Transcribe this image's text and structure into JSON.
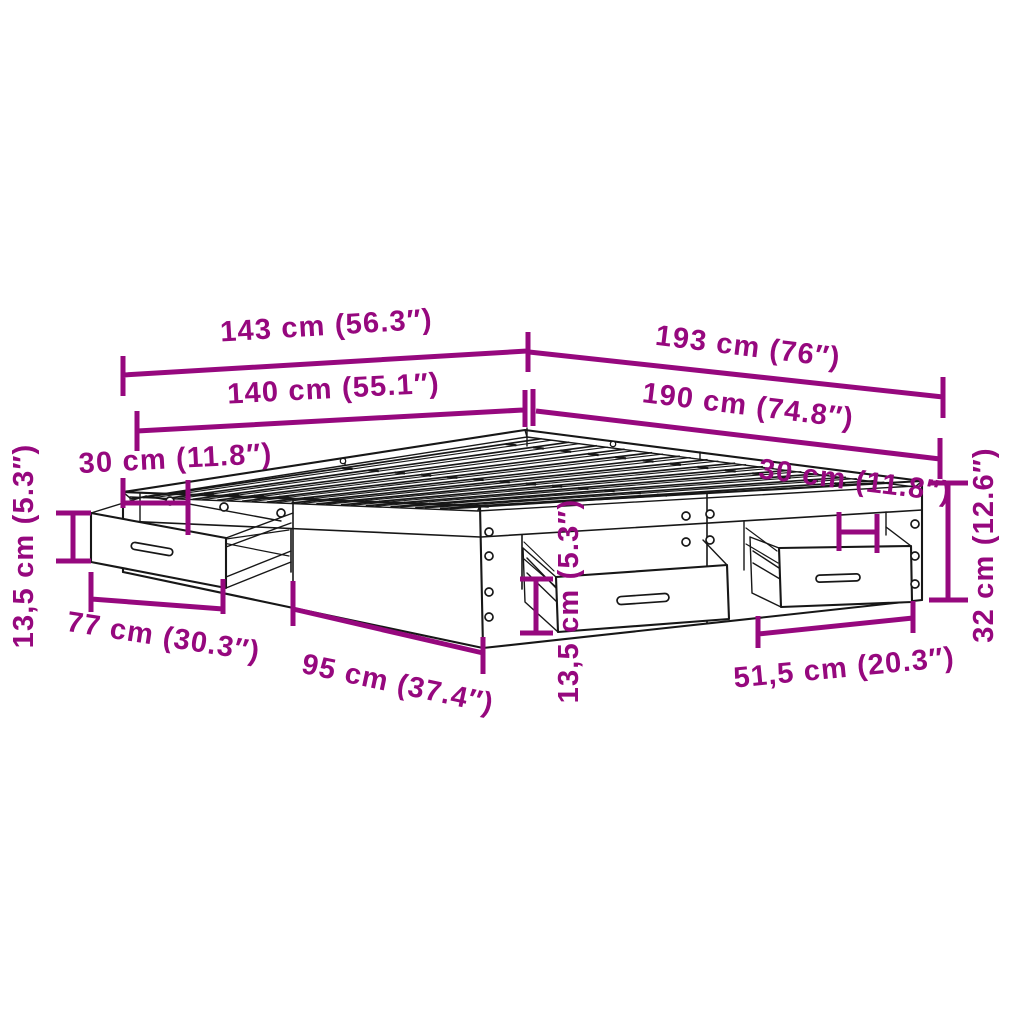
{
  "diagram": {
    "kind": "product-dimension-diagram",
    "subject": "bed-frame-with-storage-drawers",
    "accent_color": "#96087E",
    "line_color": "#171717",
    "background_color": "#ffffff",
    "dimensions": {
      "overall_width": {
        "label": "143 cm (56.3″)",
        "value_cm": "143",
        "value_in": "56.3"
      },
      "overall_length": {
        "label": "193 cm (76″)",
        "value_cm": "193",
        "value_in": "76"
      },
      "slat_width": {
        "label": "140 cm (55.1″)",
        "value_cm": "140",
        "value_in": "55.1"
      },
      "slat_length": {
        "label": "190 cm (74.8″)",
        "value_cm": "190",
        "value_in": "74.8"
      },
      "left_drawer_offset": {
        "label": "30 cm (11.8″)",
        "value_cm": "30",
        "value_in": "11.8"
      },
      "right_drawer_offset": {
        "label": "30 cm (11.8″)",
        "value_cm": "30",
        "value_in": "11.8"
      },
      "left_drawer_height": {
        "label": "13,5 cm (5.3″)",
        "value_cm": "13,5",
        "value_in": "5.3"
      },
      "front_drawer_height": {
        "label": "13,5 cm (5.3″)",
        "value_cm": "13,5",
        "value_in": "5.3"
      },
      "left_drawer_width": {
        "label": "77 cm (30.3″)",
        "value_cm": "77",
        "value_in": "30.3"
      },
      "side_panel_width": {
        "label": "95 cm (37.4″)",
        "value_cm": "95",
        "value_in": "37.4"
      },
      "right_drawer_width": {
        "label": "51,5 cm (20.3″)",
        "value_cm": "51,5",
        "value_in": "20.3"
      },
      "frame_height": {
        "label": "32 cm (12.6″)",
        "value_cm": "32",
        "value_in": "12.6"
      }
    }
  }
}
